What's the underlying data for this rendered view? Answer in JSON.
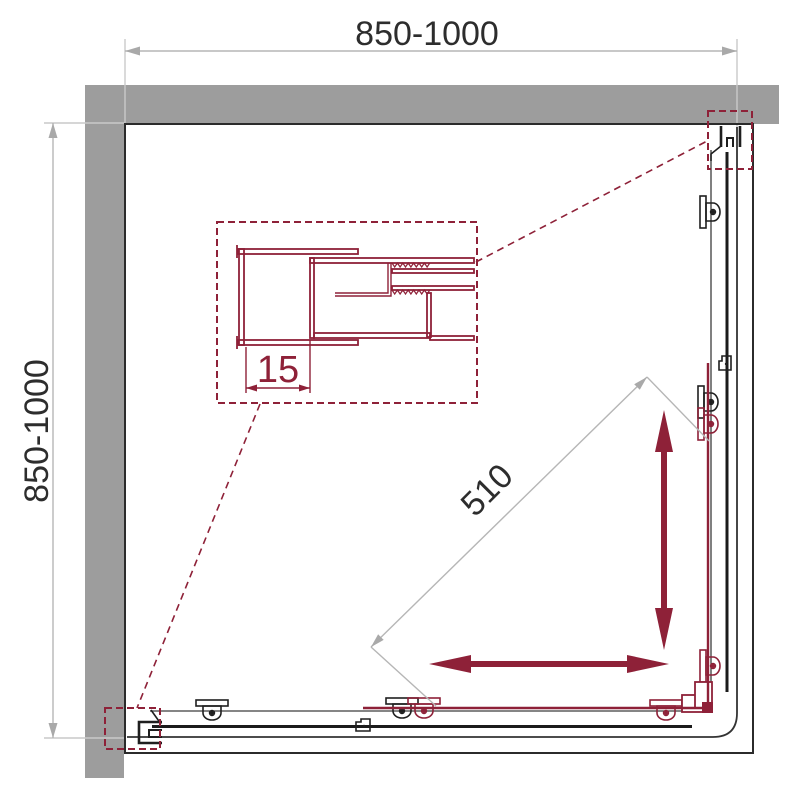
{
  "drawing": {
    "type": "shower-enclosure-corner-plan",
    "dims": {
      "top": "850-1000",
      "left": "850-1000",
      "entry": "510",
      "detail": "15"
    },
    "colors": {
      "wall_gray": "#9d9d9d",
      "accent_red": "#8e2138",
      "outline_dark": "#2b2b2b",
      "dimension_line_gray": "#b6b6b6",
      "dimension_text": "#2d2d2d"
    }
  }
}
